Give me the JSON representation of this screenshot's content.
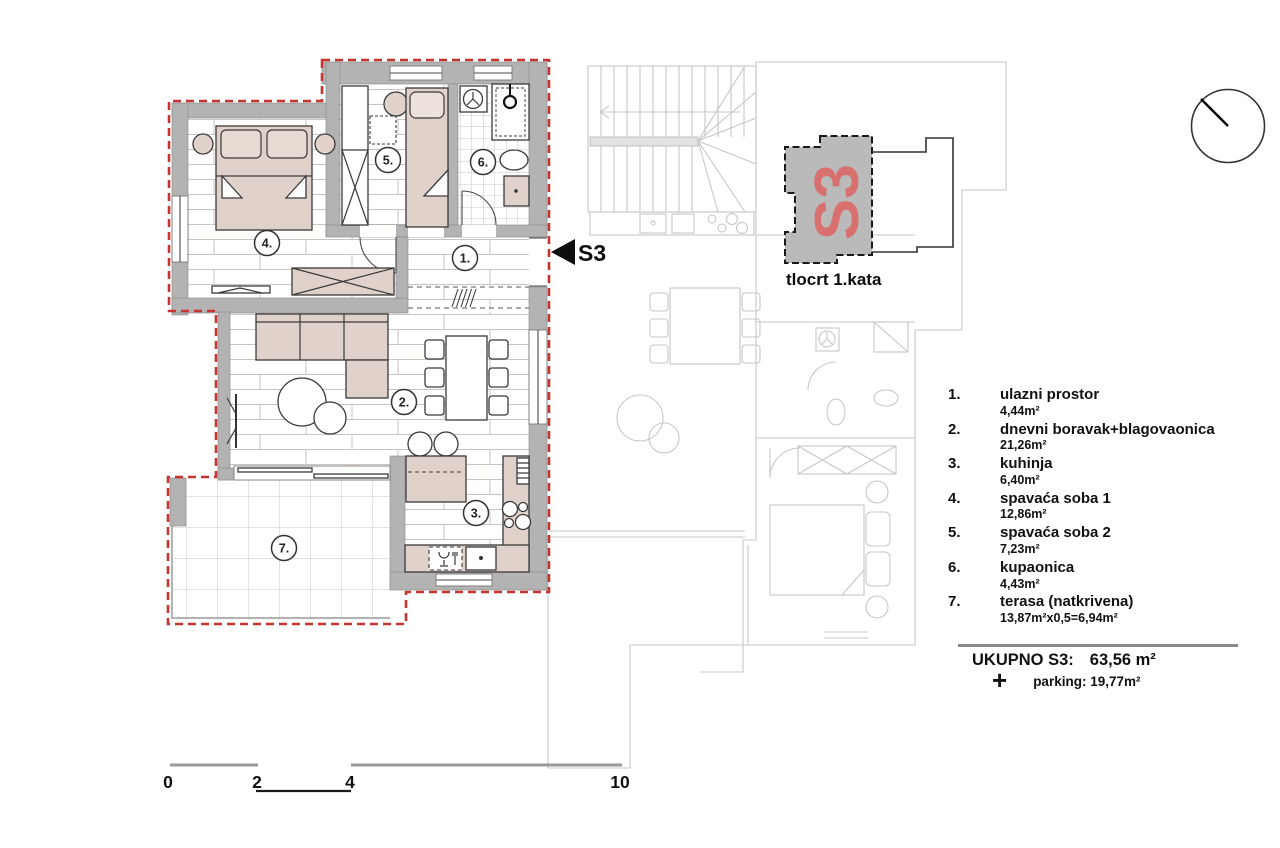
{
  "marker": {
    "label": "S3"
  },
  "inset": {
    "unit": "S3",
    "caption": "tlocrt 1.kata"
  },
  "legend": {
    "rooms": [
      {
        "num": "1.",
        "name": "ulazni prostor",
        "area": "4,44m²"
      },
      {
        "num": "2.",
        "name": "dnevni boravak+blagovaonica",
        "area": "21,26m²"
      },
      {
        "num": "3.",
        "name": "kuhinja",
        "area": "6,40m²"
      },
      {
        "num": "4.",
        "name": "spavaća soba 1",
        "area": "12,86m²"
      },
      {
        "num": "5.",
        "name": "spavaća soba 2",
        "area": "7,23m²"
      },
      {
        "num": "6.",
        "name": "kupaonica",
        "area": "4,43m²"
      },
      {
        "num": "7.",
        "name": "terasa (natkrivena)",
        "area": "13,87m²x0,5=6,94m²"
      }
    ]
  },
  "total": {
    "label": "UKUPNO S3:",
    "value": "63,56 m²",
    "plus": "+",
    "parking": "parking: 19,77m²"
  },
  "scale": {
    "ticks": [
      "0",
      "2",
      "4",
      "10"
    ]
  },
  "colors": {
    "boundary_red": "#c5342e",
    "wall_gray": "#b3b3b3",
    "furniture_fill": "#e0d2ca",
    "inset_fill": "#bababa",
    "inset_s3_red": "#d97070",
    "neighbor_gray": "#c7c7c7"
  }
}
